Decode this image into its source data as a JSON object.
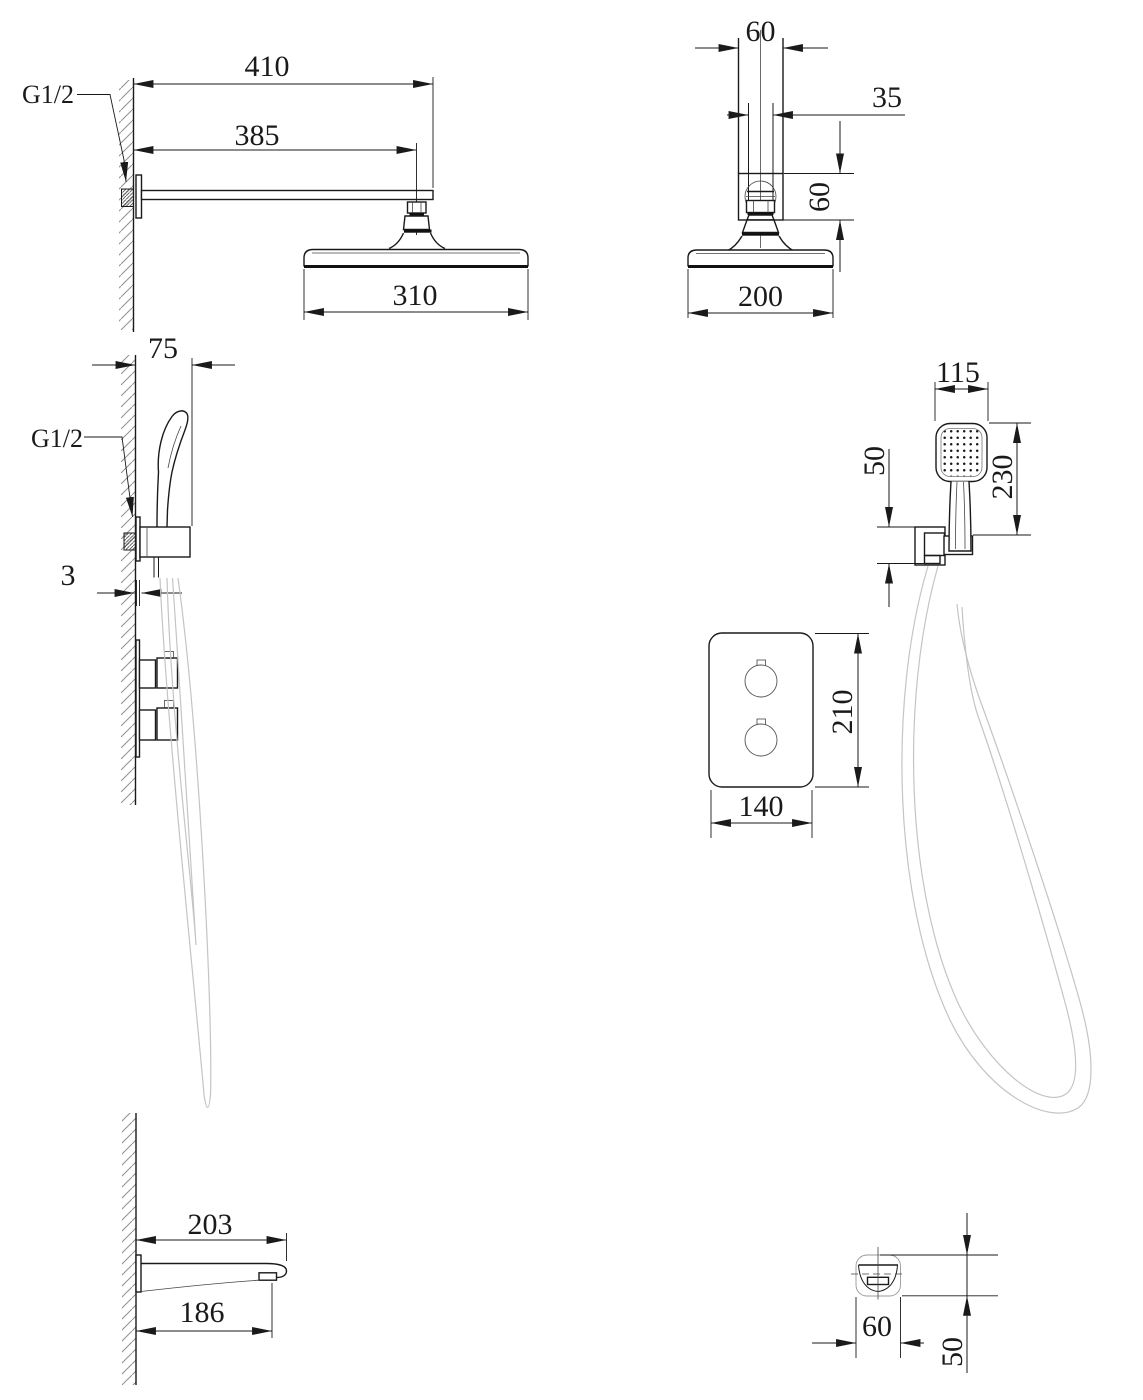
{
  "colors": {
    "background": "#ffffff",
    "line": "#1a1a1a",
    "hose": "#c4c4c4",
    "hatch": "#8f8f8f"
  },
  "views": {
    "rain_shower_side": {
      "thread_label": "G1/2",
      "dim_arm_overall": "410",
      "dim_arm_length": "385",
      "dim_head_diameter": "310"
    },
    "rain_shower_front": {
      "dim_top_width": "60",
      "dim_pipe_width": "35",
      "dim_joint_height": "60",
      "dim_head_width": "200"
    },
    "hand_shower_side": {
      "dim_bracket_depth": "75",
      "thread_label": "G1/2",
      "dim_plate_thickness": "3"
    },
    "hand_shower_front": {
      "dim_head_width": "115",
      "dim_holder_height": "50",
      "dim_overall_length": "230"
    },
    "mixer_valve_front": {
      "dim_plate_height": "210",
      "dim_plate_width": "140"
    },
    "spout_side": {
      "dim_length_overall": "203",
      "dim_length_to_aerator": "186"
    },
    "spout_front": {
      "dim_width": "60",
      "dim_height": "50"
    }
  }
}
